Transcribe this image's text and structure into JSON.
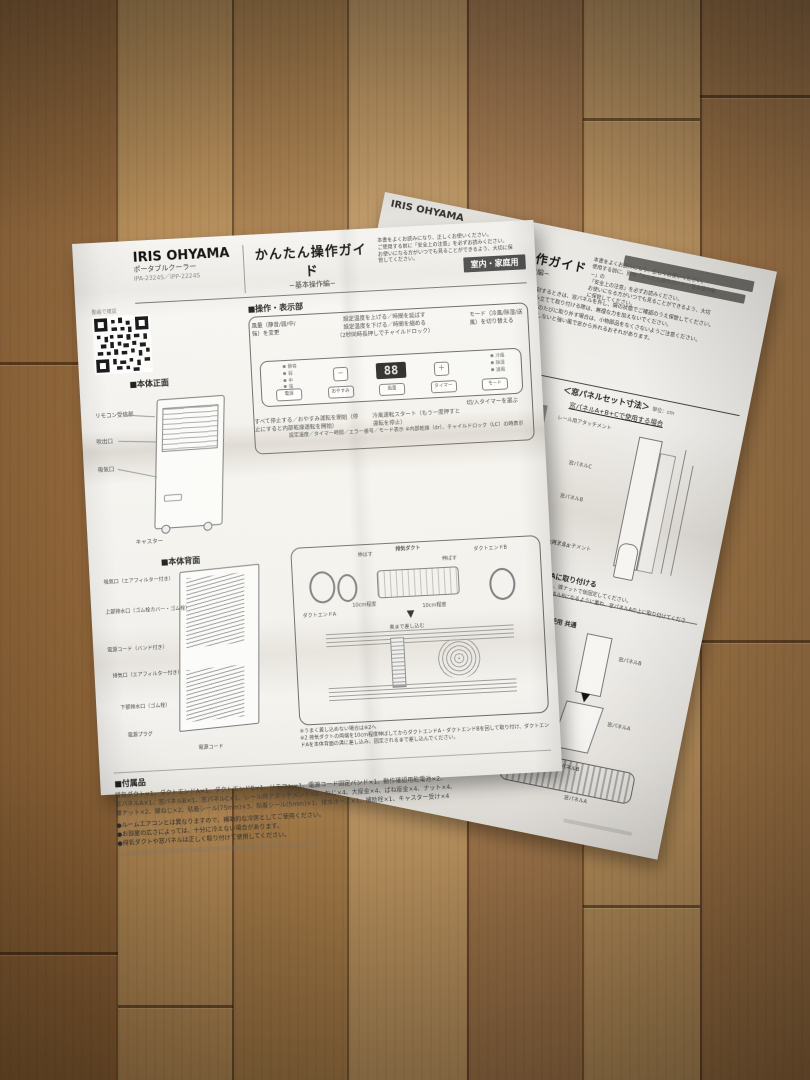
{
  "left_page": {
    "header": {
      "brand": "IRIS OHYAMA",
      "product": "ポータブルクーラー",
      "models": "IPA-2324S／IPP-2224S",
      "title": "かんたん操作ガイド",
      "subtitle": "−基本操作編−",
      "notice_lines": [
        "本書をよくお読みになり、正しくお使いください。",
        "ご使用する前に「安全上の注意」を必ずお読みください。",
        "お使いになる方がいつでも見ることができるよう、大切に保管してください。"
      ],
      "badge": "室内・家庭用",
      "qr_caption": "動画で確認"
    },
    "front": {
      "heading": "■本体正面",
      "labels": [
        "リモコン受信部",
        "吹出口",
        "吸気口",
        "キャスター"
      ]
    },
    "panel": {
      "heading": "■操作・表示部",
      "callout_fan": "風量（静音/弱/中/強）を変更",
      "callout_temp_1": "設定温度を上げる／時間を延ばす",
      "callout_temp_2": "設定温度を下げる／時間を縮める",
      "callout_temp_3": "（2秒同時長押しでチャイルドロック）",
      "callout_mode": "モード（冷風/除湿/送風）を切り替える",
      "callout_timer": "切/入タイマーを選ぶ",
      "callout_power": "すべて停止する／おやすみ運転を開始（停止にすると内部乾燥運転を開始）",
      "callout_start": "冷風運転スタート（もう一度押すと運転を停止）",
      "display_value": "88",
      "display_note_1": "設定温度／タイマー時間／エラー番号／モード表示",
      "display_note_2": "※内部乾燥（dr）、チャイルドロック（LC）の時表示",
      "minus": "−",
      "plus": "＋",
      "indicators_left": [
        "静音",
        "弱",
        "中",
        "強"
      ],
      "indicators_right": [
        "冷風",
        "除湿",
        "送風"
      ],
      "buttons": [
        "電源",
        "おやすみ",
        "風量",
        "タイマー",
        "モード"
      ]
    },
    "back": {
      "heading": "■本体背面",
      "labels": [
        "吸気口（エアフィルター付き）",
        "上部排水口（ゴム栓カバー・ゴム栓）",
        "電源コード（バンド付き）",
        "排気口（エアフィルター付き）",
        "下部排水口（ゴム栓）",
        "電源プラグ"
      ],
      "bottom_label": "電源コード",
      "duct_labels": {
        "end_a": "ダクトエンドA",
        "duct": "排気ダクト",
        "extend_left": "伸ばす",
        "extend_right": "伸ばす",
        "len_left": "10cm程度",
        "len_right": "10cm程度",
        "end_b": "ダクトエンドB",
        "insert": "奥まで差し込む"
      },
      "notes": [
        "※うまく差し込めない場合は※2へ",
        "※2 排気ダクトの両端を10cm程度伸ばしてからダクトエンドA・ダクトエンドBを回して取り付け、ダクトエンドAを本体背面の溝に差し込み、固定されるまで差し込んでください。"
      ]
    },
    "accessories": {
      "heading": "■付属品",
      "lines": [
        "排気ダクト×1、ダクトエンドA×1、ダクトエンドB×1、リモコン×1、電源コード固定バンド×1、動作確認用乾電池×2、",
        "窓パネルA×1、窓パネルB×1、窓パネルC×1、レール用アタッチメント×2、ねじ×4、大座金×4、ばね座金×4、ナット×4、",
        "蝶ナット×2、蝶ねじ×2、粘着シール(75mm)×3、粘着シール(5mm)×1、排水ホース×1、補助栓×1、キャスター受け×4"
      ],
      "notes": [
        "●ルームエアコンとは異なりますので、補助的な冷房としてご使用ください。",
        "●お部屋の広さによっては、十分に冷えない場合があります。",
        "●排気ダクトや窓パネルは正しく取り付けて使用してください。"
      ]
    }
  },
  "right_page": {
    "brand": "IRIS OHYAMA",
    "title": "かんたん操作ガイド",
    "subtitle": "−組み立て・取り付け編−",
    "notice_lines": [
      "本書をよくお読みになり、正しくお使いください。",
      "使用する前に、別冊「かんたん操作ガイド −基本操作編−」の",
      "「安全上の注意」を必ずお読みください。",
      "お使いになる方がいつでも見ることができるよう、大切に保管してください。"
    ],
    "fragments": [
      "…タイミングで交換",
      "…ルを取り外し"
    ],
    "bullets": [
      "●開封するときは、窓パネルを外し、袋の状態でご確認のうえ保管してください。",
      "●組み立てて取り付ける際は、無理な力を加えないでください。",
      "●使用のたびに取り外す場合は、小物部品をなくさないようご注意ください。",
      "●固定しないと強い風で窓から外れるおそれがあります。"
    ],
    "dims": {
      "heading": "＜窓パネルセット寸法＞",
      "unit": "単位：cm",
      "subheading": "窓パネルA+B+Cで使用する場合",
      "step_number": "1",
      "labels": [
        "レール用アタッチメント",
        "窓パネルC",
        "窓パネルB",
        "窓パネルA"
      ]
    },
    "attach": {
      "attachment_label": "レール用アタッチメント",
      "heading": "窓パネルBを窓パネルAに取り付ける",
      "body_lines": [
        "・窓パネルBの穴に蝶ねじを通し、蝶ナットで仮固定してください。",
        "　下側が窓パネルA、上側が窓パネルBになるように重ね、窓パネルAの上に取り付けてください。"
      ],
      "common": "パネル（A,B）・（A,B,C）使用 共通",
      "nut_label": "蝶ナット位置",
      "panel_b": "窓パネルB",
      "panel_a": "窓パネルA"
    },
    "section_view": {
      "badge": "断面図",
      "panel_a_top": "窓パネルA",
      "panel_a_side": "窓パネルA",
      "panel_b": "窓パネルB",
      "panel_a_bottom": "窓パネルA"
    }
  }
}
